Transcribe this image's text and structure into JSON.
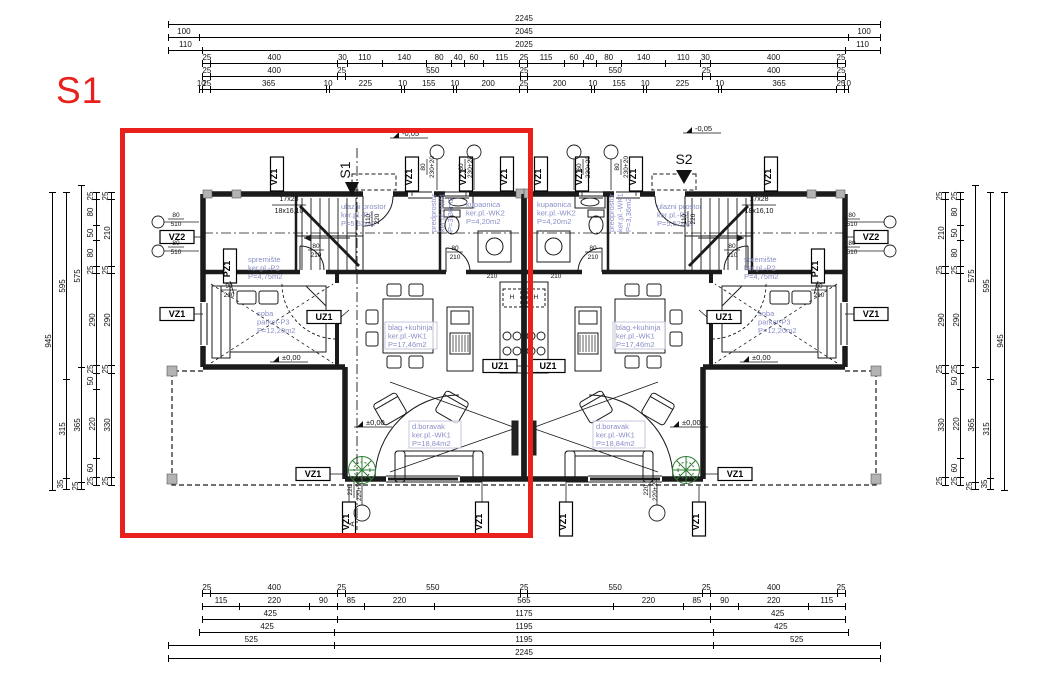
{
  "marker_s1": "S1",
  "entry_markers": {
    "left": "S1",
    "right": "S2"
  },
  "section_marker": "A",
  "colors": {
    "highlight_red": "#e8211d",
    "room_text_blue": "#8a8fc7",
    "plant_green": "#2e7d32"
  },
  "tags": {
    "vz1": "VZ1",
    "vz2": "VZ2",
    "pz1": "PZ1",
    "uz1": "UZ1"
  },
  "levels": {
    "zero": "±0,00",
    "minus": "-0,05"
  },
  "stairs": {
    "top": "17x28",
    "bottom": "18x16,10"
  },
  "fixtures": {
    "hood": "H"
  },
  "rooms": {
    "ulazni": [
      "ulazni prostor",
      "ker.pl.-P2",
      "P=5,52m2"
    ],
    "spremiste": [
      "spremište",
      "ker.pl.-P2",
      "P=4,75m2"
    ],
    "kupaonica": [
      "kupaonica",
      "ker.pl.-WK2",
      "P=4,20m2"
    ],
    "predprostor": [
      "predprostor",
      "ker.pl.-WK1",
      "P=3,36m2"
    ],
    "soba": [
      "soba",
      "parket-P3",
      "P=12,20m2"
    ],
    "blag": [
      "blag.+kuhinja",
      "ker.pl.-WK1",
      "P=17,46m2"
    ],
    "dnevni": [
      "d.boravak",
      "ker.pl.-WK1",
      "P=18,84m2"
    ]
  },
  "opening_dims": {
    "door80": [
      "80",
      "210"
    ],
    "door90": [
      "90",
      "210"
    ],
    "door110": [
      "110",
      "220"
    ],
    "win80": [
      "80",
      "230+20"
    ],
    "win60": [
      "60",
      "230+20"
    ],
    "flue": [
      "80",
      "510"
    ],
    "terrace_win": [
      "220",
      "220+20"
    ],
    "k210": "210"
  },
  "dim_chains": {
    "top": [
      {
        "offset": 0,
        "segments": [
          2245
        ]
      },
      {
        "offset": 0,
        "segments": [
          100,
          2045,
          100
        ]
      },
      {
        "offset": 0,
        "segments": [
          110,
          2025,
          110
        ]
      },
      {
        "offset": 110,
        "segments": [
          25,
          400,
          30,
          110,
          140,
          80,
          40,
          60,
          115,
          25,
          115,
          60,
          40,
          80,
          140,
          110,
          30,
          400,
          25
        ]
      },
      {
        "offset": 110,
        "segments": [
          25,
          400,
          25,
          550,
          25,
          550,
          25,
          400,
          25
        ]
      },
      {
        "offset": 100,
        "segments": [
          10,
          25,
          365,
          10,
          225,
          10,
          155,
          10,
          200,
          25,
          200,
          10,
          155,
          10,
          225,
          10,
          365,
          25,
          10
        ]
      }
    ],
    "bottom": [
      {
        "offset": 110,
        "segments": [
          25,
          400,
          25,
          550,
          25,
          550,
          25,
          400,
          25
        ]
      },
      {
        "offset": 110,
        "segments": [
          115,
          220,
          90,
          85,
          220,
          565,
          220,
          85,
          90,
          220,
          115
        ]
      },
      {
        "offset": 110,
        "segments": [
          425,
          1175,
          425
        ]
      },
      {
        "offset": 100,
        "segments": [
          425,
          1195,
          425
        ]
      },
      {
        "offset": 0,
        "segments": [
          525,
          1195,
          525
        ]
      },
      {
        "offset": 0,
        "segments": [
          2245
        ]
      }
    ],
    "left": [
      {
        "offset": 0,
        "segments": [
          945
        ]
      },
      {
        "offset": 0,
        "segments": [
          595,
          315,
          35
        ]
      },
      {
        "offset": -20,
        "segments": [
          575,
          365,
          25
        ]
      },
      {
        "offset": 0,
        "segments": [
          25,
          80,
          50,
          80,
          25,
          290,
          25,
          50,
          220,
          60,
          25
        ]
      },
      {
        "offset": 0,
        "segments": [
          25,
          210,
          25,
          290,
          25,
          330,
          25
        ]
      }
    ],
    "right": [
      {
        "offset": 0,
        "segments": [
          945
        ]
      },
      {
        "offset": 0,
        "segments": [
          595,
          315,
          35
        ]
      },
      {
        "offset": -20,
        "segments": [
          575,
          365,
          25
        ]
      },
      {
        "offset": 0,
        "segments": [
          25,
          80,
          50,
          80,
          25,
          290,
          25,
          50,
          220,
          60,
          25
        ]
      },
      {
        "offset": 0,
        "segments": [
          25,
          210,
          25,
          290,
          25,
          330,
          25
        ]
      }
    ]
  }
}
